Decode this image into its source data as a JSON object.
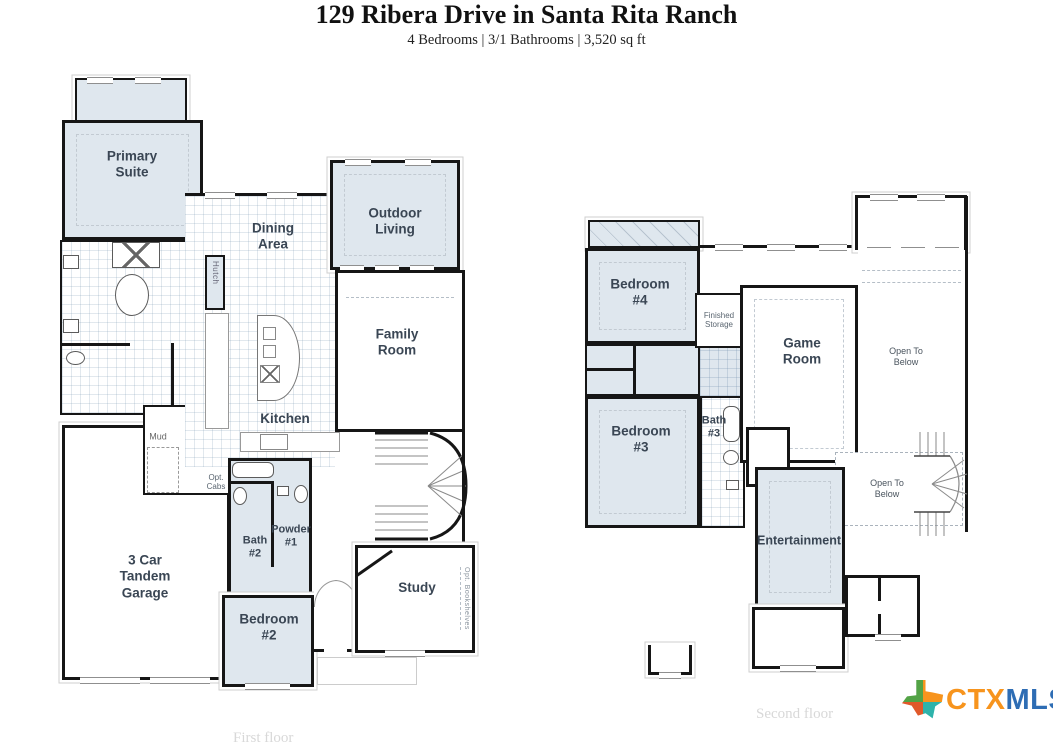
{
  "header": {
    "title": "129 Ribera Drive in Santa Rita Ranch",
    "subtitle": "4 Bedrooms | 3/1 Bathrooms | 3,520 sq ft"
  },
  "first_floor": {
    "caption": "First floor",
    "rooms": {
      "primary_suite": "Primary\nSuite",
      "dining_area": "Dining\nArea",
      "hutch": "Hutch",
      "outdoor_living": "Outdoor\nLiving",
      "family_room": "Family\nRoom",
      "kitchen": "Kitchen",
      "mud": "Mud",
      "opt_sink": "Opt.\nSink",
      "opt_cabs": "Opt.\nCabs",
      "bath_2": "Bath\n#2",
      "powder_1": "Powder\n#1",
      "garage": "3 Car\nTandem\nGarage",
      "bedroom_2": "Bedroom\n#2",
      "study": "Study",
      "opt_bookshelves": "Opt. Bookshelves"
    }
  },
  "second_floor": {
    "caption": "Second floor",
    "rooms": {
      "bedroom_4": "Bedroom\n#4",
      "finished_storage": "Finished\nStorage",
      "game_room": "Game\nRoom",
      "open_to_below_upper": "Open To\nBelow",
      "bedroom_3": "Bedroom\n#3",
      "bath_3": "Bath\n#3",
      "open_to_below_lower": "Open To\nBelow",
      "entertainment": "Entertainment"
    }
  },
  "logo": {
    "ctx": "CTX",
    "mls": "MLS"
  },
  "colors": {
    "room_fill": "#dfe7ee",
    "wall": "#161616",
    "room_label": "#3a4654",
    "floor_caption": "#d8d8d8",
    "logo_ctx": "#f7941d",
    "logo_mls": "#2e6db4",
    "texas_green": "#53a346",
    "texas_orange": "#f7941d",
    "texas_red": "#e0592a",
    "texas_teal": "#2eb3ab"
  }
}
